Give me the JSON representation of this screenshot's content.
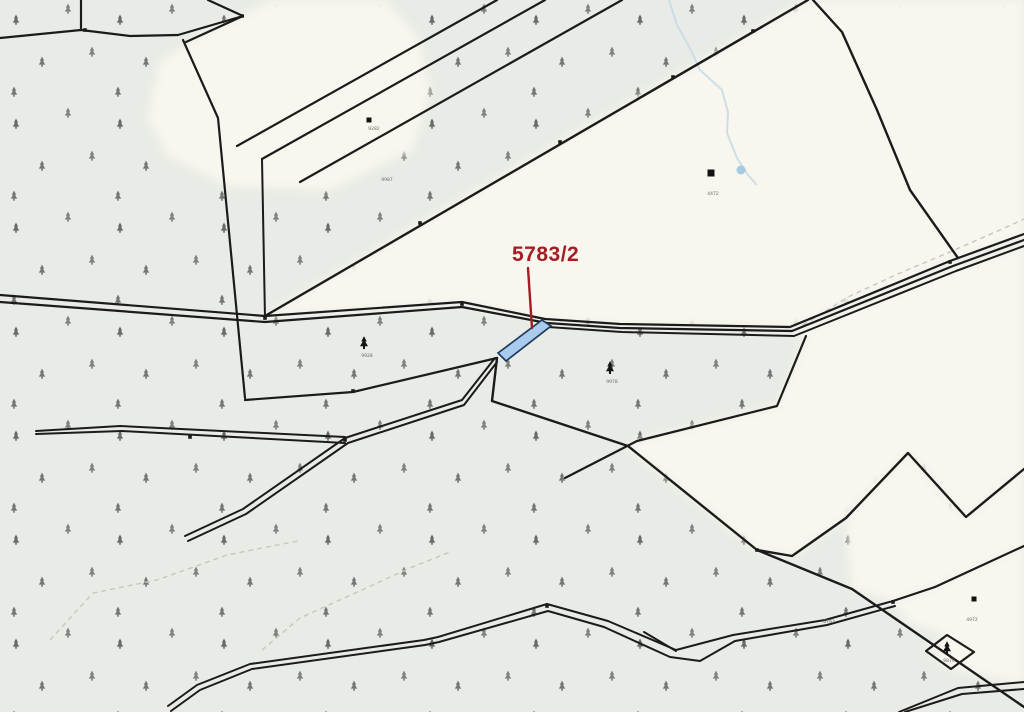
{
  "map": {
    "background": {
      "forest_color": "#e9ece6",
      "field_color": "#f8f6ee",
      "tree_glyph_color": "#ccd9c6",
      "boundary_color": "#1b1b1b",
      "dashed_path_color": "#c6c6c0"
    },
    "highlight": {
      "label_text": "5783/2",
      "label_color": "#a51d23",
      "label_x": 512,
      "label_y": 261,
      "leader": "528,268 532,328",
      "parcel_points": "498,353 542,320 551,326 506,361",
      "parcel_fill": "#a9ccee",
      "parcel_stroke": "#1f3a5c"
    },
    "water": {
      "color": "#c5d9e8",
      "stream": "669,0 677,25 690,48 700,70 722,90 728,112 727,133 737,158 748,175 757,185",
      "pond": {
        "cx": 741,
        "cy": 170,
        "r": 4.5,
        "fill": "#9fc7e0"
      }
    },
    "open_areas": [
      {
        "name": "field-top-middle",
        "points": "148,118 160,62 205,33 250,12 273,0 385,0 418,38 430,92 412,150 330,190 228,186 168,156"
      },
      {
        "name": "field-top-right",
        "points": "265,316 420,223 560,142 673,77 753,31 808,0 1024,0 1024,236 950,261 792,328 620,325 546,320 462,303"
      },
      {
        "name": "field-right-middle",
        "points": "792,334 953,268 1024,247 1024,469 966,517 908,453 846,518 792,556 757,550 628,446 637,441 777,406 806,338"
      },
      {
        "name": "field-below-zigzag",
        "points": "908,455 966,517 1024,470 1024,546 935,587 893,601 852,589 846,518"
      },
      {
        "name": "field-bottom-right",
        "points": "893,601 935,587 1024,546 1024,684 952,668 926,651 947,635 908,622"
      }
    ],
    "boundaries": [
      {
        "name": "top-left-vertical",
        "points": "81,0 81,30",
        "w": 2.2
      },
      {
        "name": "top-left-west",
        "points": "0,38 81,30",
        "w": 2.2
      },
      {
        "name": "top-left-east",
        "points": "81,30 130,36 178,35",
        "w": 2.2
      },
      {
        "name": "wedge-top",
        "points": "178,35 243,16",
        "w": 2.2
      },
      {
        "name": "wedge-bottom",
        "points": "186,42 243,16",
        "w": 2.2
      },
      {
        "name": "wedge-tip-north",
        "points": "243,16 208,0",
        "w": 2.2
      },
      {
        "name": "strip-a",
        "points": "497,0 237,146",
        "w": 2.2
      },
      {
        "name": "strip-b",
        "points": "545,0 262,159",
        "w": 2.2
      },
      {
        "name": "strip-b-drop",
        "points": "262,159 265,318",
        "w": 2
      },
      {
        "name": "strip-c",
        "points": "622,0 300,182",
        "w": 2.2
      },
      {
        "name": "long-diagonal",
        "points": "808,0 265,316",
        "w": 2.4
      },
      {
        "name": "west-boundary",
        "points": "183,40 218,118 245,398",
        "w": 2.2
      },
      {
        "name": "right-boundary",
        "points": "813,0 842,32 877,110 910,190 958,258",
        "w": 2.4
      },
      {
        "name": "road-line-1",
        "points": "0,295 265,316 462,302 545,319 620,324 790,327 950,261 1024,234",
        "w": 2.2
      },
      {
        "name": "road-line-2",
        "points": "0,302 265,322 462,307 547,323 620,328 792,331 953,266 1024,240",
        "w": 2.2
      },
      {
        "name": "road-line-3",
        "points": "548,327 622,332 794,336 956,271 1024,246",
        "w": 2
      },
      {
        "name": "mid-boundary",
        "points": "245,400 353,392 497,358",
        "w": 2.2
      },
      {
        "name": "track-upper",
        "points": "185,536 243,509 345,438 462,400 495,358",
        "w": 2
      },
      {
        "name": "track-lower",
        "points": "188,541 246,514 348,443 464,405 497,362",
        "w": 2
      },
      {
        "name": "sliver-top",
        "points": "36,431 120,426 345,437",
        "w": 2
      },
      {
        "name": "sliver-bottom",
        "points": "36,434 122,431 345,443",
        "w": 2
      },
      {
        "name": "center-chain",
        "points": "497,358 492,401 628,446 757,550 852,589 1024,707",
        "w": 2.4
      },
      {
        "name": "cross-boundary",
        "points": "806,336 777,406 637,441 565,478",
        "w": 2.2
      },
      {
        "name": "zigzag",
        "points": "757,550 792,556 846,518 908,453 966,517 1024,469",
        "w": 2.4
      },
      {
        "name": "bottom-path-upper",
        "points": "168,706 197,685 250,664 424,640 438,637 547,604 608,621 676,650 733,635 825,620 893,601",
        "w": 2
      },
      {
        "name": "bottom-path-lower",
        "points": "171,711 200,690 252,669 425,645 439,642 548,611 604,627 670,657 700,661 735,641 827,625 895,606",
        "w": 2
      },
      {
        "name": "fork-prong",
        "points": "676,651 644,632",
        "w": 2
      },
      {
        "name": "bottom-right-edge",
        "points": "893,601 935,587 1024,546",
        "w": 2.2
      },
      {
        "name": "corner-path-upper",
        "points": "899,712 958,688 1024,682",
        "w": 2
      },
      {
        "name": "corner-path-lower",
        "points": "905,712 962,694 1024,689",
        "w": 2
      },
      {
        "name": "diamond-parcel",
        "points": "926,651 947,635 974,652 951,669",
        "w": 2.2,
        "closed": true
      }
    ],
    "dashed_paths": [
      {
        "name": "footpath-southwest-a",
        "points": "50,640 93,593 157,580 227,555 298,541"
      },
      {
        "name": "footpath-southwest-b",
        "points": "262,650 300,618 362,590 410,568 450,552"
      },
      {
        "name": "footpath-northeast",
        "points": "795,330 850,296 900,273 950,252 1000,230 1024,219"
      }
    ],
    "vertex_nodes": [
      {
        "x": 242,
        "y": 16
      },
      {
        "x": 462,
        "y": 304
      },
      {
        "x": 190,
        "y": 437
      },
      {
        "x": 345,
        "y": 440
      },
      {
        "x": 353,
        "y": 391
      },
      {
        "x": 673,
        "y": 77
      },
      {
        "x": 753,
        "y": 31
      },
      {
        "x": 560,
        "y": 142
      },
      {
        "x": 420,
        "y": 223
      },
      {
        "x": 950,
        "y": 262
      },
      {
        "x": 547,
        "y": 606
      },
      {
        "x": 893,
        "y": 602
      },
      {
        "x": 757,
        "y": 550
      },
      {
        "x": 265,
        "y": 318
      },
      {
        "x": 85,
        "y": 30
      }
    ],
    "buildings": [
      {
        "x": 369,
        "y": 120,
        "s": 5
      },
      {
        "x": 711,
        "y": 173,
        "s": 7
      },
      {
        "x": 974,
        "y": 599,
        "s": 5
      }
    ],
    "tree_symbols": [
      {
        "x": 364,
        "y": 343
      },
      {
        "x": 610,
        "y": 368
      },
      {
        "x": 947,
        "y": 648
      }
    ],
    "parcel_labels": [
      {
        "text": "9282",
        "x": 374,
        "y": 130
      },
      {
        "text": "9987",
        "x": 387,
        "y": 181
      },
      {
        "text": "9928",
        "x": 367,
        "y": 357
      },
      {
        "text": "9978",
        "x": 612,
        "y": 383
      },
      {
        "text": "4472",
        "x": 713,
        "y": 195
      },
      {
        "text": "4972",
        "x": 972,
        "y": 621
      },
      {
        "text": "9879",
        "x": 949,
        "y": 662
      },
      {
        "text": "6793",
        "x": 829,
        "y": 623
      }
    ]
  }
}
